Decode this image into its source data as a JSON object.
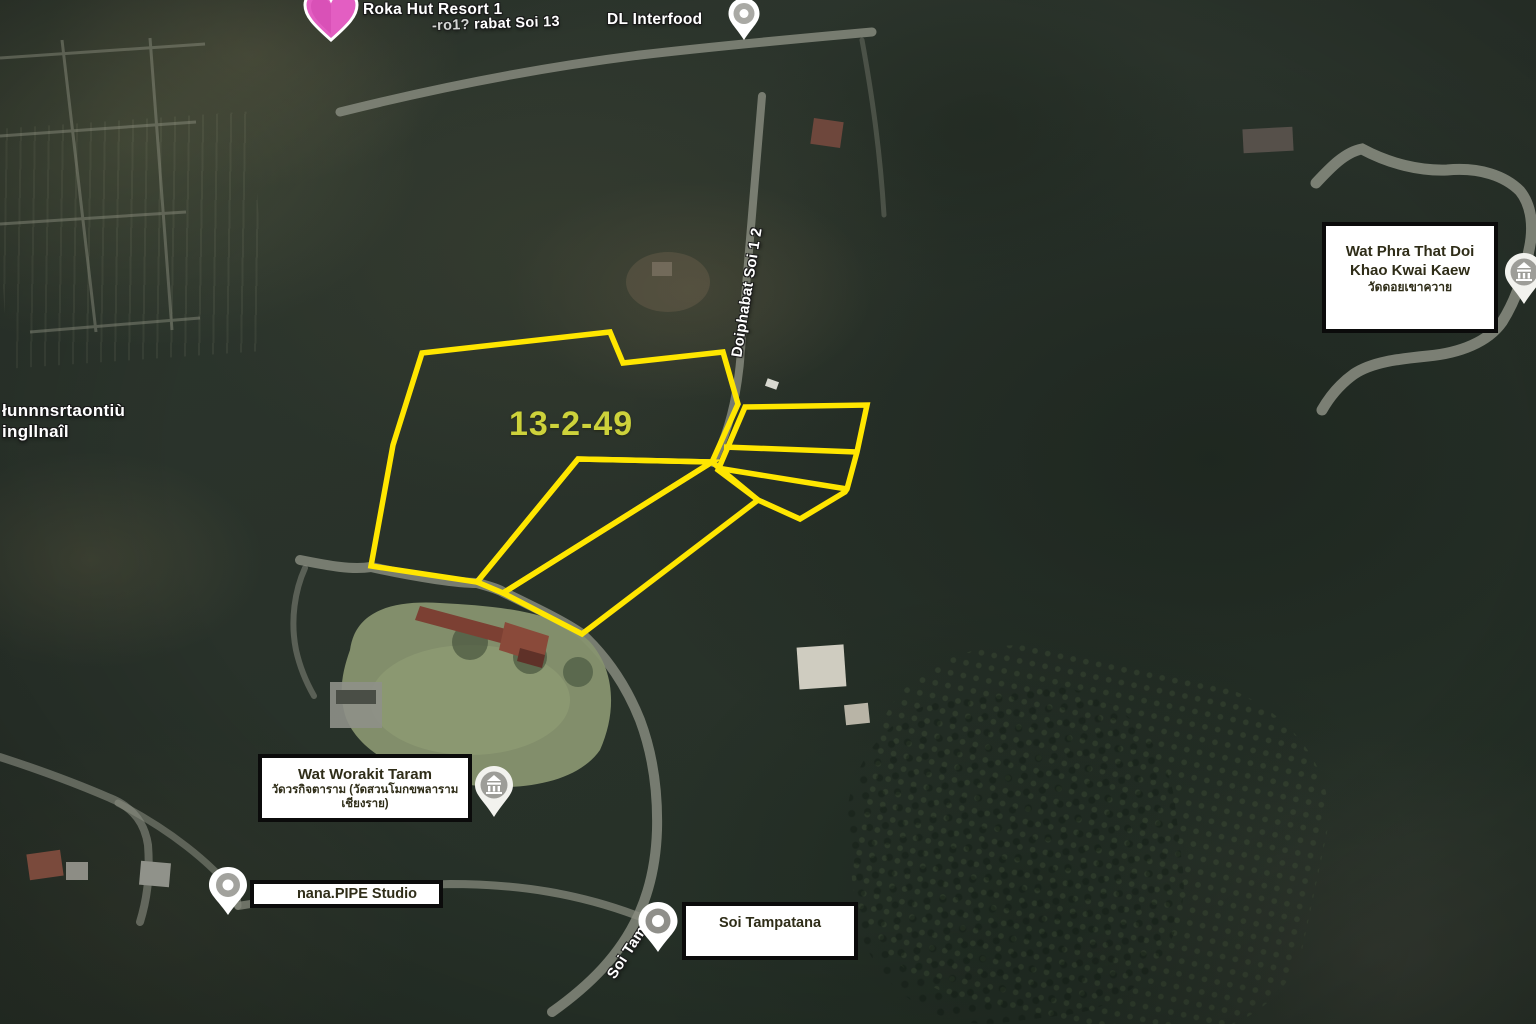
{
  "map": {
    "labels": {
      "resort": "Roka Hut Resort 1",
      "soi13_prefix": "-ro1? ",
      "soi13": "rabat Soi 13",
      "dl_interfood": "DL Interfood",
      "thai_area_line1": "łunnnsrtaontiù",
      "thai_area_line2": "ingllnaîl",
      "road_doiphabat": "Doiphabat Soi 1 2",
      "road_soi_tam": "Soi Tam"
    },
    "parcel_label": "13-2-49",
    "info_boxes": {
      "wat_phra_that": {
        "line1": "Wat Phra That Doi",
        "line2": "Khao Kwai Kaew",
        "line3": "วัดดอยเขาควาย"
      },
      "wat_worakit": {
        "line1": "Wat Worakit Taram",
        "line2": "วัดวรกิจตาราม (วัดสวนโมกขพลาราม",
        "line3": "เชียงราย)"
      },
      "nana_pipe": {
        "line1": "nana.PIPE Studio"
      },
      "soi_tampatana": {
        "line1": "Soi Tampatana"
      }
    },
    "colors": {
      "parcel_outline": "#ffe600",
      "parcel_label_text": "#cdd23b",
      "box_border": "#0b0b0b",
      "box_background": "#ffffff",
      "box_text": "#2f2d18",
      "heart_pin": "#e35ec2",
      "road": "#8b8e82"
    }
  }
}
